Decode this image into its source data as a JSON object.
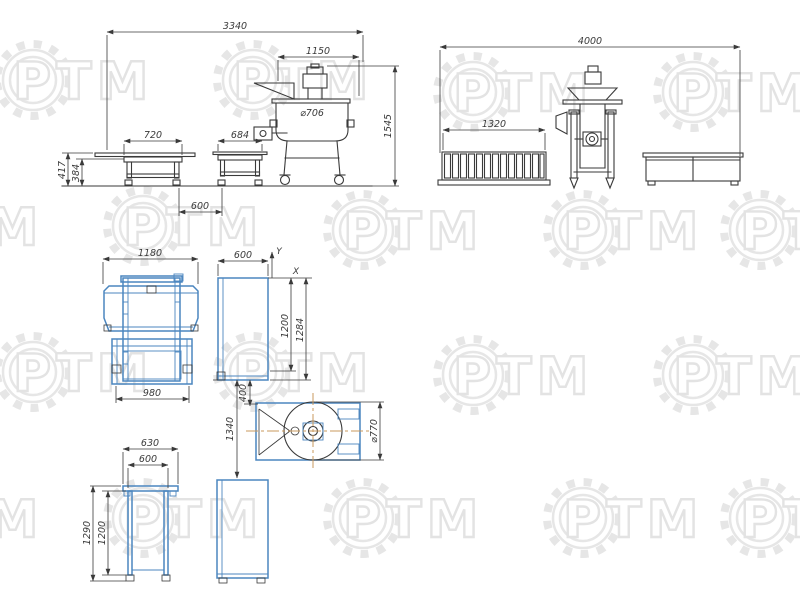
{
  "watermark": {
    "text": "РТМ"
  },
  "colors": {
    "line": "#3a3a3a",
    "blue": "#4b86bf",
    "centerline": "#c9995c",
    "watermark": "#e6e6e6"
  },
  "views": {
    "front": {
      "overall_width": "3340",
      "machine_width": "1150",
      "mixer_diameter": "⌀706",
      "table1_width": "720",
      "table2_width": "684",
      "tables_gap": "600",
      "belt_height": "417",
      "table_height": "384",
      "machine_height": "1545"
    },
    "side": {
      "overall_width": "4000",
      "conveyor_width": "1320"
    },
    "plan": {
      "tables_width": "1180",
      "tables_inner_width": "980",
      "stand_width": "600",
      "stand_height": "1200",
      "stand_overall_height": "1284",
      "gap": "400",
      "span": "1340",
      "rotor_diameter": "⌀770",
      "axis_x": "X",
      "axis_y": "Y"
    },
    "stand_front": {
      "outer_width": "630",
      "inner_width": "600",
      "outer_height": "1290",
      "inner_height": "1200"
    }
  }
}
